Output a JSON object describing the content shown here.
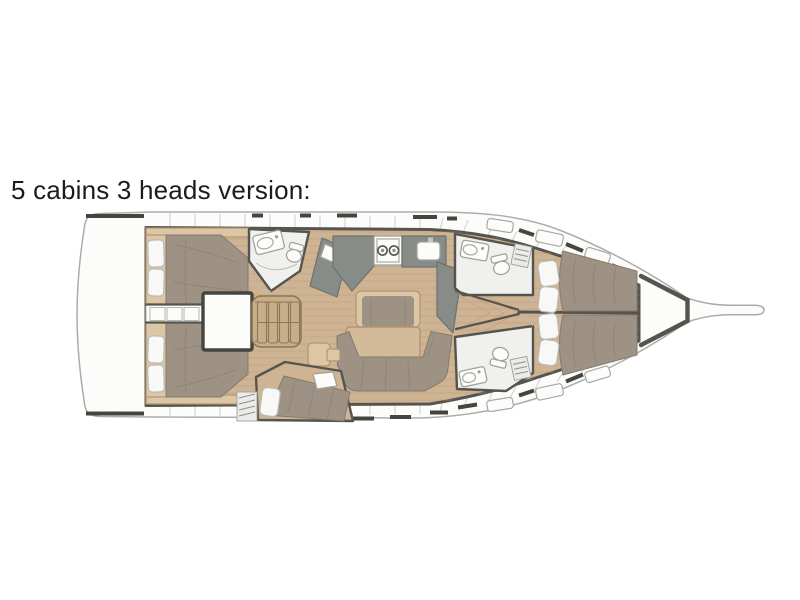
{
  "title": "5 cabins 3 heads version:",
  "plan": {
    "type": "sailing-yacht-interior-floor-plan",
    "orientation": "bow-right",
    "cabins": 5,
    "heads": 3
  },
  "palette": {
    "page_bg": "#ffffff",
    "text_color": "#1c1c1c",
    "hull_line": "#a9aeac",
    "wall": "#55544e",
    "window": "#45453f",
    "deck_seam": "#ccd0ce",
    "wood": "#cfb494",
    "wood_light": "#dcc6a6",
    "plank": "#b3946f",
    "mattress": "#9d9284",
    "mattress_shade": "#857a6d",
    "pillow": "#f8f8f6",
    "pillow_line": "#b9b9b5",
    "counter": "#878c89",
    "counter_edge": "#6e726e",
    "fixture": "#fcfcfa",
    "room_floor": "#f0f0ee",
    "ladder": "#c8ad89",
    "ladder_edge": "#8a7758",
    "table_wood": "#d3ba98",
    "table_edge": "#b2946e"
  }
}
